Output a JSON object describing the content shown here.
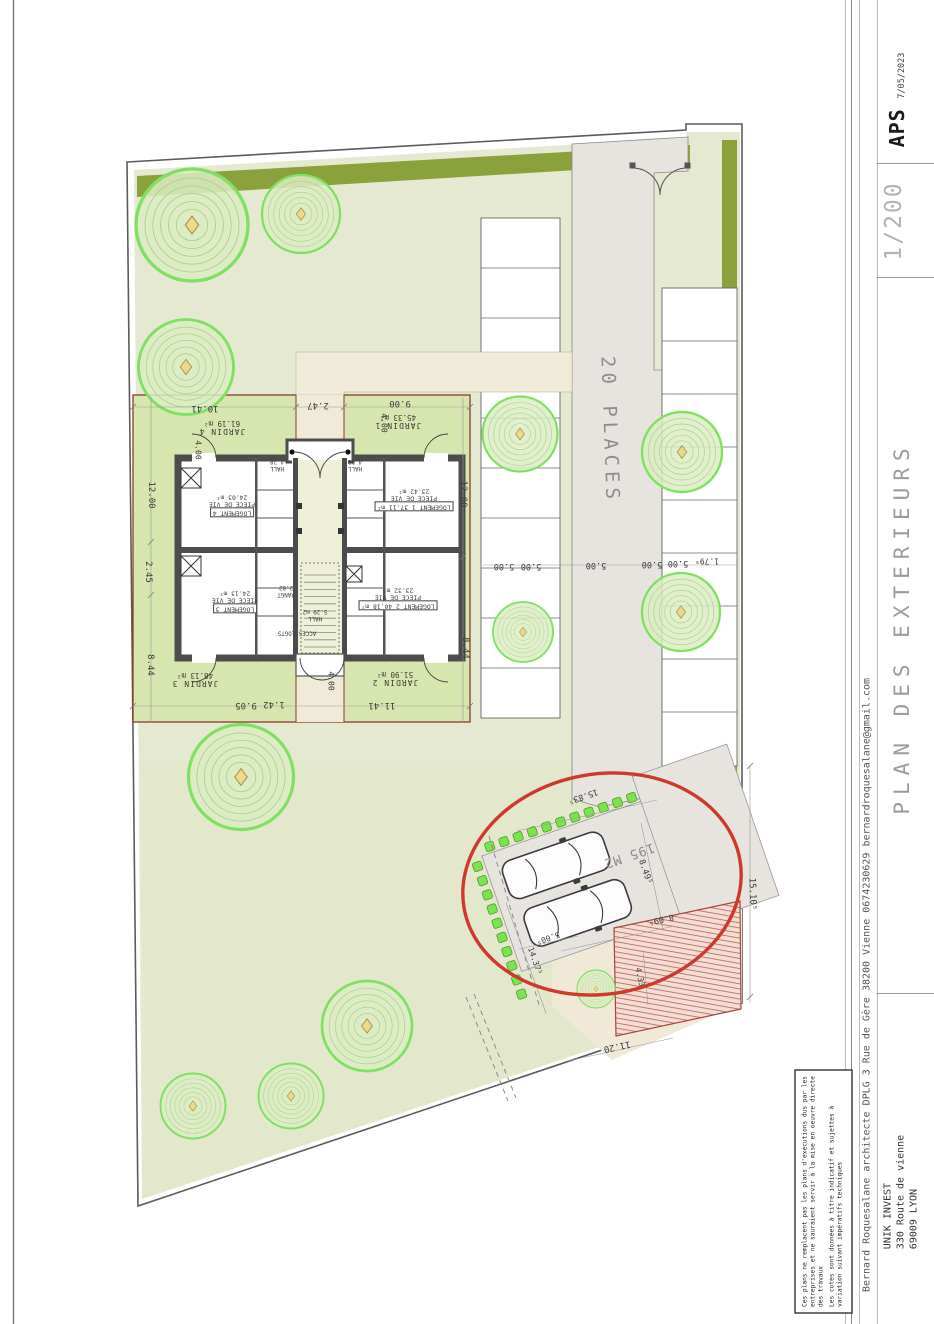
{
  "title_block": {
    "phase_label": "APS",
    "date": "7/05/2023",
    "scale": "1/200",
    "sheet_title": "PLAN DES EXTERIEURS",
    "architect_line": "Bernard Roquesalane architecte DPLG 3 Rue de Gère 38200 Vienne 0674230629 bernardroquesalane@gmail.com",
    "client_name": "UNIK INVEST",
    "client_address_1": "330 Route de vienne",
    "client_address_2": "69009 LYON",
    "disclaimer_1": "Ces plans ne remplacent pas les plans d'exécutions dus par les entreprises et ne sauraient servir à la mise en oeuvre directe des travaux",
    "disclaimer_2": "Les cotes sont données à titre indicatif et sujettes à variation suivant impératifs techniques"
  },
  "site_plan": {
    "parking_label": "20 PLACES",
    "surface_label": "195 M2",
    "gardens": [
      {
        "name": "JARDIN 4",
        "area": "61.19 m²"
      },
      {
        "name": "JARDIN 1",
        "area": "45.33 m²"
      },
      {
        "name": "JARDIN 3",
        "area": "48.13 m²"
      },
      {
        "name": "JARDIN 2",
        "area": "51.90 m²"
      }
    ],
    "units": [
      {
        "label": "LOGEMENT 4",
        "room": "PIECE DE VIE",
        "area": "24.03 m²"
      },
      {
        "label": "LOGEMENT 1 37.11 m²",
        "room": "PIECE DE VIE",
        "area": "23.42 m²"
      },
      {
        "label": "LOGEMENT 3",
        "room": "PIECE DE VIE",
        "area": "24.13 m²"
      },
      {
        "label": "LOGEMENT 2 40.18 m²",
        "room": "PIECE DE VIE",
        "area": "23.32 m²"
      }
    ],
    "small_rooms": [
      {
        "label": "HALL",
        "area": "4.28"
      },
      {
        "label": "HALL",
        "area": "4.28"
      },
      {
        "label": "HALL",
        "area": "5.29 m2"
      },
      {
        "label": "RANGT",
        "area": "2.02"
      },
      {
        "label": "ACCES LOGTS",
        "area": ""
      }
    ],
    "dimensions": [
      "12.00",
      "2.45",
      "8.44",
      "4.00",
      "10.41",
      "2.47",
      "9.00",
      "4.00",
      "12.00",
      "8.44",
      "4.00",
      "9.05",
      "1.42",
      "11.41",
      "5.00",
      "5.00",
      "5.00",
      "5.00",
      "5.00",
      "1.79⁵",
      "15.83⁵",
      "8.49⁵",
      "8.09⁵",
      "5.00⁵",
      "14.37⁵",
      "11.20",
      "15.10⁵",
      "4.33"
    ]
  },
  "colors": {
    "garden": "#e6e9d2",
    "jardin": "#d7e6ae",
    "hedge": "#8ba23c",
    "drive": "#e7e4df",
    "annotation_red": "#cf392c",
    "hatch_stripe": "#bb5f52",
    "property_line": "#8a3b2b"
  }
}
